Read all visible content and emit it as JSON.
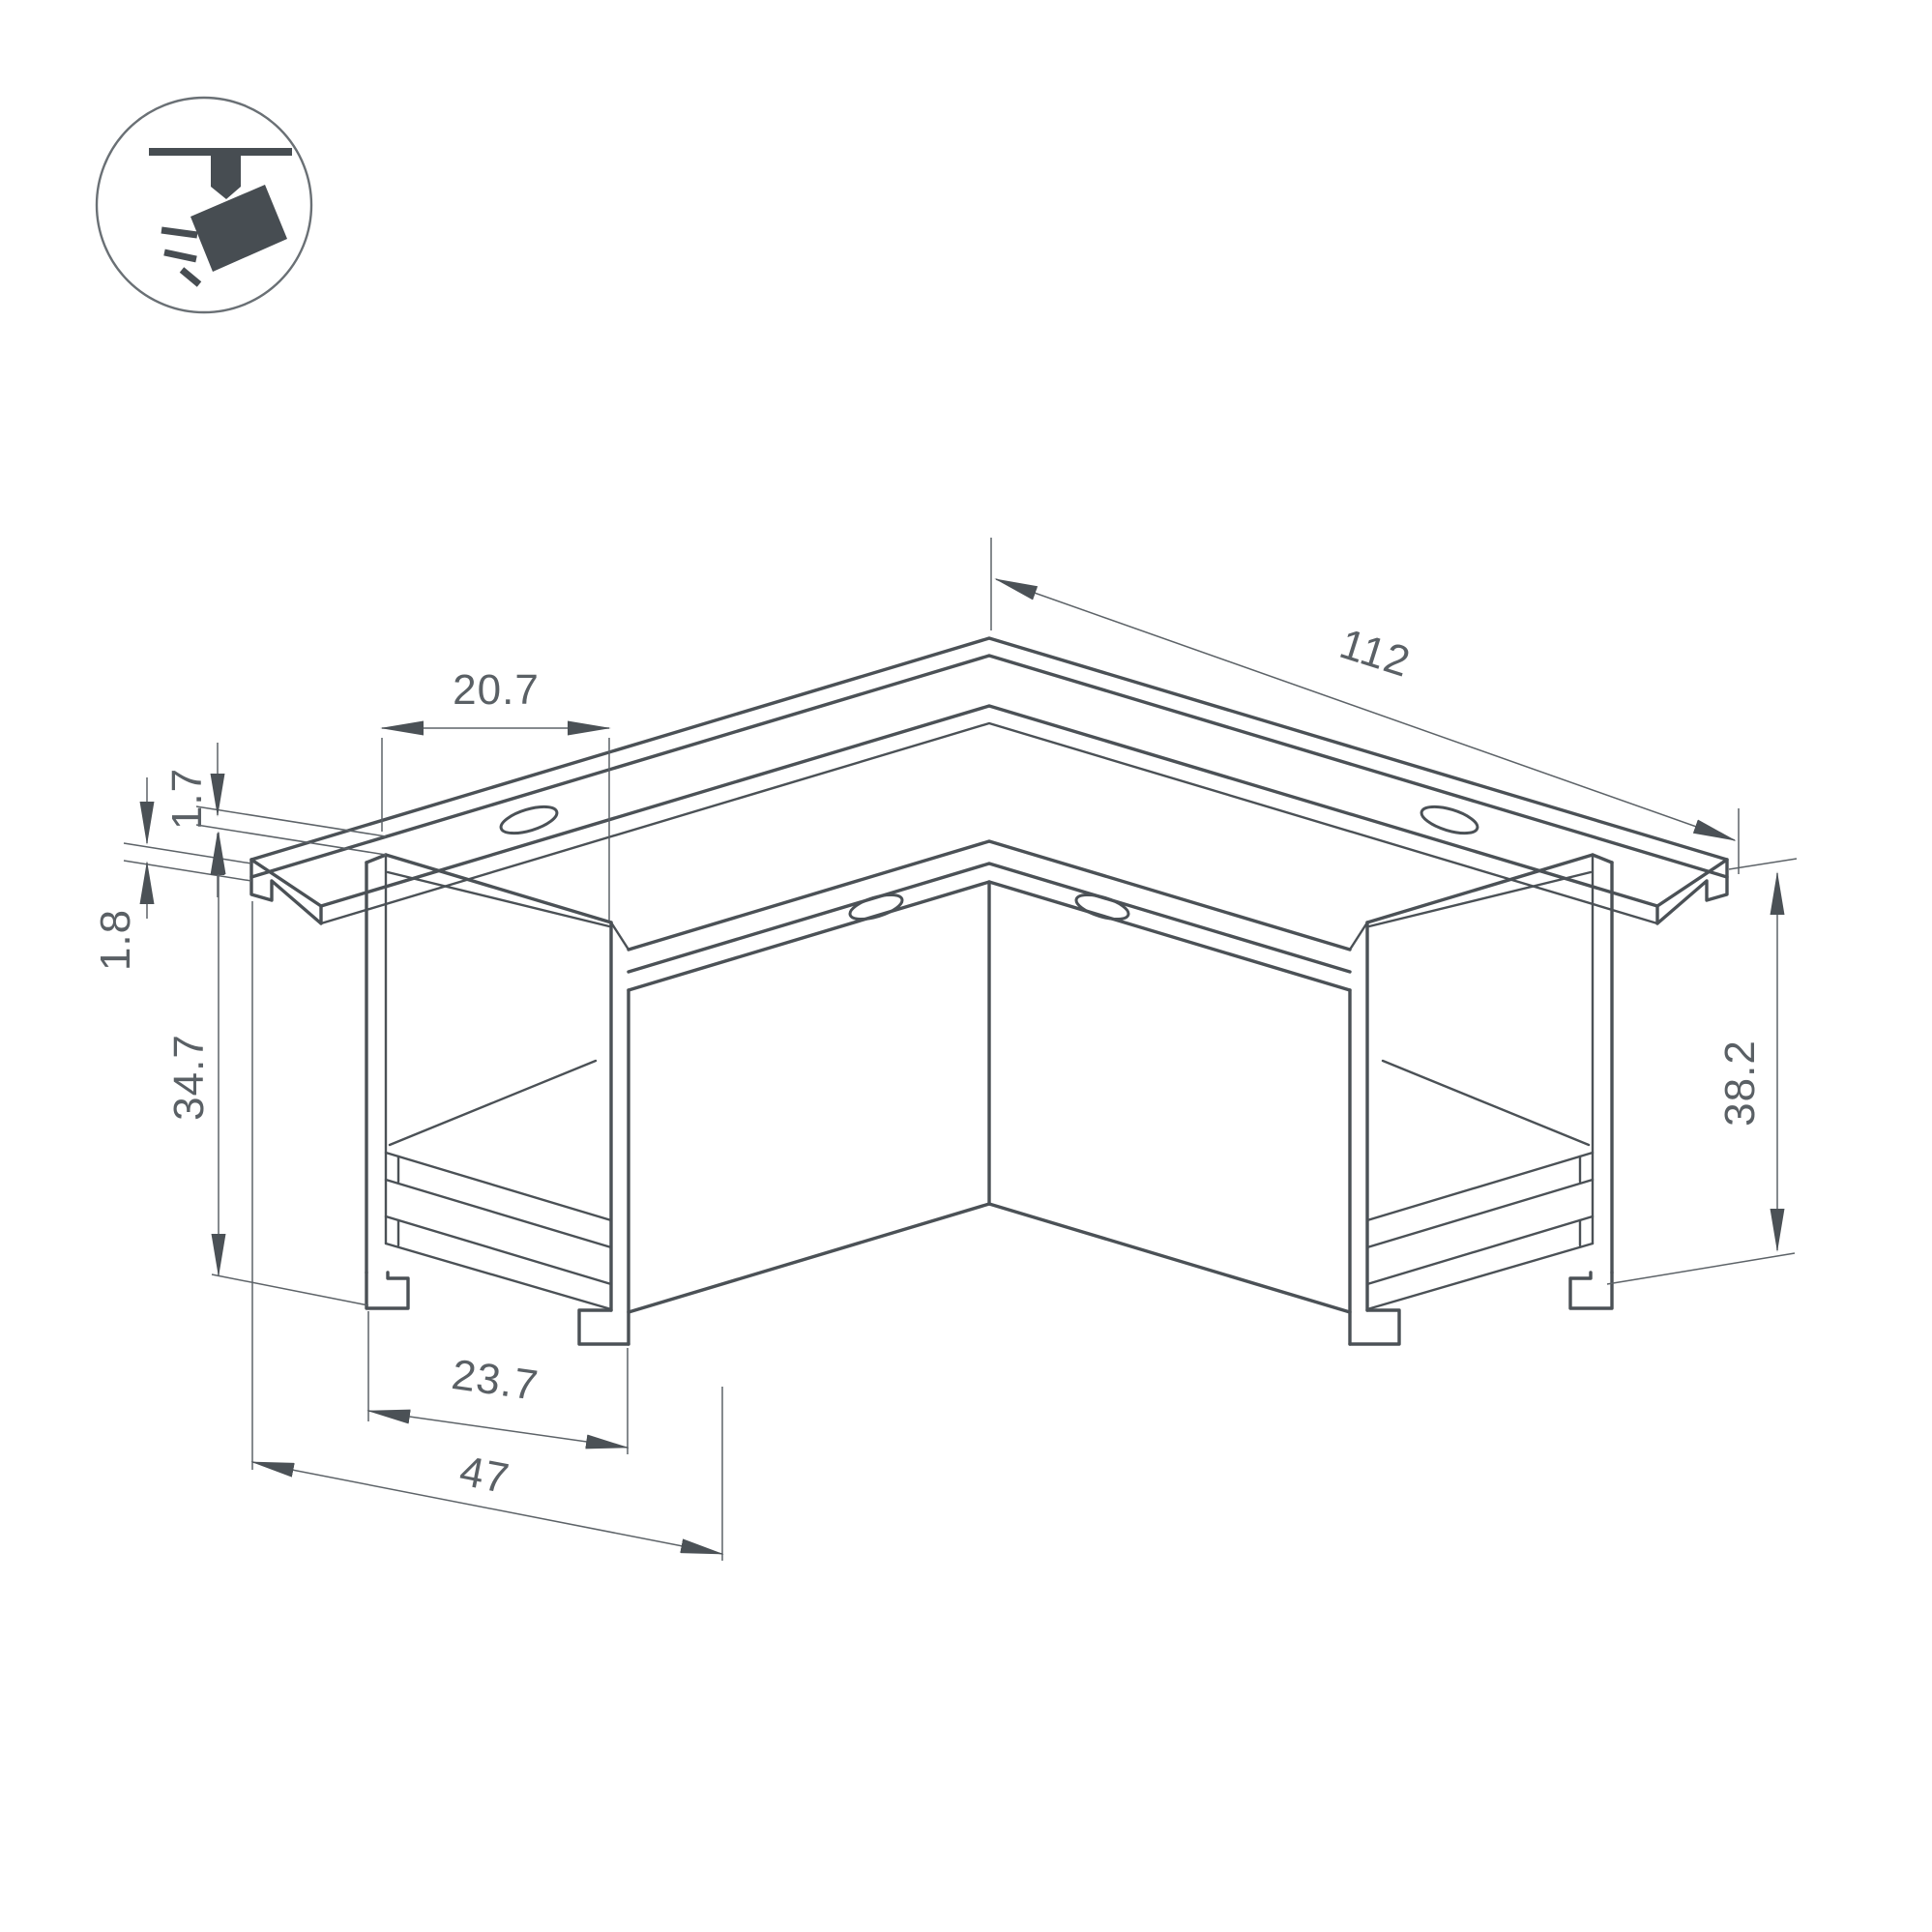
{
  "meta": {
    "background_color": "#ffffff",
    "line_color": "#4b5156",
    "dimension_text_color": "#5a6065",
    "icon_color": "#474d52"
  },
  "icon": {
    "name": "ceiling-track-spotlight"
  },
  "drawing": {
    "dimensions": {
      "flange_overhang": "20.7",
      "flange_thickness": "1.7",
      "mount_gap": "1.8",
      "body_height": "34.7",
      "arm_length": "112",
      "channel_width": "23.7",
      "overall_width": "47",
      "overall_height": "38.2"
    }
  }
}
